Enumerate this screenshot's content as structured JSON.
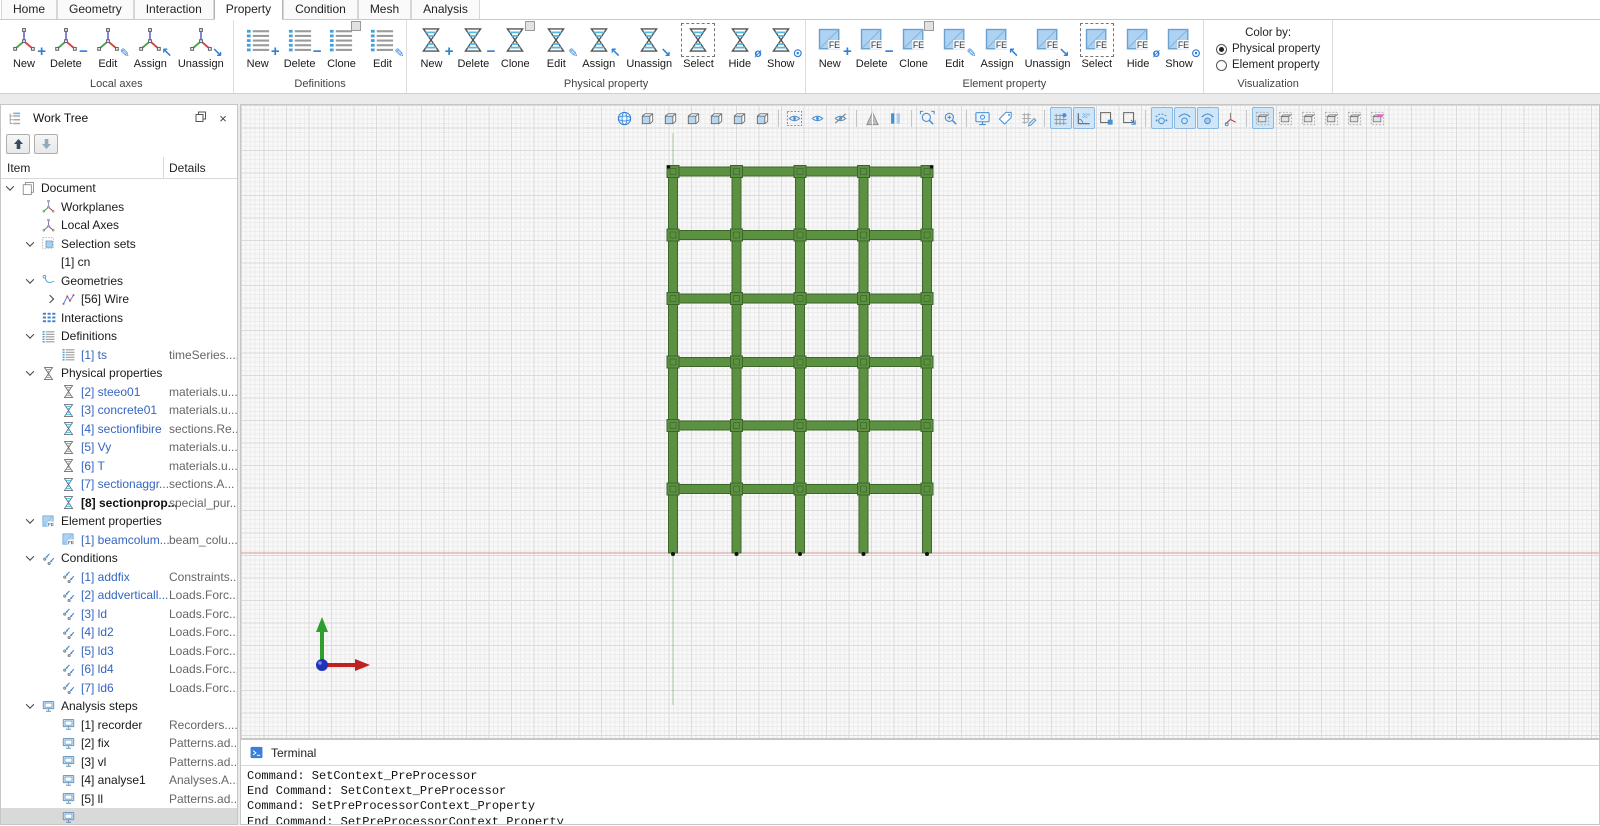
{
  "colors": {
    "accent_blue": "#2f7fd6",
    "toolbar_active_bg": "#cfe6f8",
    "tree_link_blue": "#3565c0",
    "structure_green": "#5b9140",
    "structure_outline": "#3d662b",
    "ground_line_red": "#d77f7f",
    "axis_line_green": "#69a65a",
    "triad_x_red": "#c02020",
    "triad_y_green": "#2e9e2e",
    "triad_origin_blue": "#2233bb"
  },
  "ribbon": {
    "tabs": [
      {
        "label": "Home"
      },
      {
        "label": "Geometry"
      },
      {
        "label": "Interaction"
      },
      {
        "label": "Property"
      },
      {
        "label": "Condition"
      },
      {
        "label": "Mesh"
      },
      {
        "label": "Analysis"
      }
    ],
    "active_tab": "Property",
    "groups": [
      {
        "label": "Local axes",
        "icon": "local-axes",
        "buttons": [
          {
            "label": "New",
            "mod": "plus"
          },
          {
            "label": "Delete",
            "mod": "minus"
          },
          {
            "label": "Edit",
            "mod": "edit"
          },
          {
            "label": "Assign",
            "mod": "assign"
          },
          {
            "label": "Unassign",
            "mod": "unassign"
          }
        ]
      },
      {
        "label": "Definitions",
        "icon": "list",
        "buttons": [
          {
            "label": "New",
            "mod": "plus"
          },
          {
            "label": "Delete",
            "mod": "minus"
          },
          {
            "label": "Clone",
            "mod": "clone"
          },
          {
            "label": "Edit",
            "mod": "edit"
          }
        ]
      },
      {
        "label": "Physical property",
        "icon": "hourglass",
        "buttons": [
          {
            "label": "New",
            "mod": "plus"
          },
          {
            "label": "Delete",
            "mod": "minus"
          },
          {
            "label": "Clone",
            "mod": "clone"
          },
          {
            "label": "Edit",
            "mod": "edit"
          },
          {
            "label": "Assign",
            "mod": "assign"
          },
          {
            "label": "Unassign",
            "mod": "unassign"
          },
          {
            "label": "Select",
            "mod": "select"
          },
          {
            "label": "Hide",
            "mod": "hide"
          },
          {
            "label": "Show",
            "mod": "show"
          }
        ]
      },
      {
        "label": "Element property",
        "icon": "fe-square",
        "buttons": [
          {
            "label": "New",
            "mod": "plus"
          },
          {
            "label": "Delete",
            "mod": "minus"
          },
          {
            "label": "Clone",
            "mod": "clone"
          },
          {
            "label": "Edit",
            "mod": "edit"
          },
          {
            "label": "Assign",
            "mod": "assign"
          },
          {
            "label": "Unassign",
            "mod": "unassign"
          },
          {
            "label": "Select",
            "mod": "select"
          },
          {
            "label": "Hide",
            "mod": "hide"
          },
          {
            "label": "Show",
            "mod": "show"
          }
        ]
      }
    ],
    "visualization": {
      "label": "Visualization",
      "color_by_label": "Color by:",
      "options": [
        {
          "label": "Physical property",
          "selected": true
        },
        {
          "label": "Element property",
          "selected": false
        }
      ]
    }
  },
  "worktree": {
    "title": "Work Tree",
    "columns": [
      "Item",
      "Details"
    ],
    "toolbar": [
      {
        "name": "move-up",
        "enabled": true
      },
      {
        "name": "move-down",
        "enabled": false
      }
    ],
    "rows": [
      {
        "label": "Document",
        "details": "",
        "level": 0,
        "icon": "document",
        "exp": "open",
        "style": "normal"
      },
      {
        "label": "Workplanes",
        "details": "",
        "level": 1,
        "icon": "workplanes",
        "exp": "",
        "style": "normal"
      },
      {
        "label": "Local Axes",
        "details": "",
        "level": 1,
        "icon": "local-axes",
        "exp": "",
        "style": "normal"
      },
      {
        "label": "Selection sets",
        "details": "",
        "level": 1,
        "icon": "selection-sets",
        "exp": "open",
        "style": "normal"
      },
      {
        "label": "[1] cn",
        "details": "",
        "level": 2,
        "icon": "",
        "exp": "",
        "style": "normal"
      },
      {
        "label": "Geometries",
        "details": "",
        "level": 1,
        "icon": "geometries",
        "exp": "open",
        "style": "normal"
      },
      {
        "label": "[56] Wire",
        "details": "",
        "level": 2,
        "icon": "wire",
        "exp": "closed",
        "style": "normal"
      },
      {
        "label": "Interactions",
        "details": "",
        "level": 1,
        "icon": "interactions",
        "exp": "",
        "style": "normal"
      },
      {
        "label": "Definitions",
        "details": "",
        "level": 1,
        "icon": "definitions",
        "exp": "open",
        "style": "normal"
      },
      {
        "label": "[1] ts",
        "details": "timeSeries....",
        "level": 2,
        "icon": "definitions",
        "exp": "",
        "style": "link"
      },
      {
        "label": "Physical properties",
        "details": "",
        "level": 1,
        "icon": "physical",
        "exp": "open",
        "style": "normal"
      },
      {
        "label": "[2] steeo01",
        "details": "materials.u...",
        "level": 2,
        "icon": "physical",
        "exp": "",
        "style": "link"
      },
      {
        "label": "[3] concrete01",
        "details": "materials.u...",
        "level": 2,
        "icon": "physical",
        "exp": "",
        "style": "link"
      },
      {
        "label": "[4] sectionfibire",
        "details": "sections.Re...",
        "level": 2,
        "icon": "physical",
        "exp": "",
        "style": "link"
      },
      {
        "label": "[5] Vy",
        "details": "materials.u...",
        "level": 2,
        "icon": "physical",
        "exp": "",
        "style": "link"
      },
      {
        "label": "[6] T",
        "details": "materials.u...",
        "level": 2,
        "icon": "physical",
        "exp": "",
        "style": "link"
      },
      {
        "label": "[7] sectionaggr...",
        "details": "sections.A...",
        "level": 2,
        "icon": "physical",
        "exp": "",
        "style": "link"
      },
      {
        "label": "[8] sectionprop...",
        "details": "special_pur...",
        "level": 2,
        "icon": "physical",
        "exp": "",
        "style": "bold"
      },
      {
        "label": "Element properties",
        "details": "",
        "level": 1,
        "icon": "element",
        "exp": "open",
        "style": "normal"
      },
      {
        "label": "[1] beamcolum...",
        "details": "beam_colu...",
        "level": 2,
        "icon": "element",
        "exp": "",
        "style": "link"
      },
      {
        "label": "Conditions",
        "details": "",
        "level": 1,
        "icon": "conditions",
        "exp": "open",
        "style": "normal"
      },
      {
        "label": "[1] addfix",
        "details": "Constraints...",
        "level": 2,
        "icon": "conditions",
        "exp": "",
        "style": "link"
      },
      {
        "label": "[2] addverticall...",
        "details": "Loads.Forc...",
        "level": 2,
        "icon": "conditions",
        "exp": "",
        "style": "link"
      },
      {
        "label": "[3] ld",
        "details": "Loads.Forc...",
        "level": 2,
        "icon": "conditions",
        "exp": "",
        "style": "link"
      },
      {
        "label": "[4] ld2",
        "details": "Loads.Forc...",
        "level": 2,
        "icon": "conditions",
        "exp": "",
        "style": "link"
      },
      {
        "label": "[5] ld3",
        "details": "Loads.Forc...",
        "level": 2,
        "icon": "conditions",
        "exp": "",
        "style": "link"
      },
      {
        "label": "[6] ld4",
        "details": "Loads.Forc...",
        "level": 2,
        "icon": "conditions",
        "exp": "",
        "style": "link"
      },
      {
        "label": "[7] ld6",
        "details": "Loads.Forc...",
        "level": 2,
        "icon": "conditions",
        "exp": "",
        "style": "link"
      },
      {
        "label": "Analysis steps",
        "details": "",
        "level": 1,
        "icon": "analysis",
        "exp": "open",
        "style": "normal"
      },
      {
        "label": "[1] recorder",
        "details": "Recorders....",
        "level": 2,
        "icon": "analysis",
        "exp": "",
        "style": "normal"
      },
      {
        "label": "[2] fix",
        "details": "Patterns.ad...",
        "level": 2,
        "icon": "analysis",
        "exp": "",
        "style": "normal"
      },
      {
        "label": "[3] vl",
        "details": "Patterns.ad...",
        "level": 2,
        "icon": "analysis",
        "exp": "",
        "style": "normal"
      },
      {
        "label": "[4] analyse1",
        "details": "Analyses.A...",
        "level": 2,
        "icon": "analysis",
        "exp": "",
        "style": "normal"
      },
      {
        "label": "[5] ll",
        "details": "Patterns.ad...",
        "level": 2,
        "icon": "analysis",
        "exp": "",
        "style": "normal"
      },
      {
        "label": "",
        "details": "",
        "level": 2,
        "icon": "analysis",
        "exp": "",
        "style": "normal",
        "selected": true
      }
    ]
  },
  "viewport": {
    "toolbar": [
      {
        "name": "isometric-view"
      },
      {
        "name": "front-view"
      },
      {
        "name": "back-view"
      },
      {
        "name": "left-view"
      },
      {
        "name": "right-view"
      },
      {
        "name": "top-view"
      },
      {
        "name": "bottom-view"
      },
      {
        "sep": true
      },
      {
        "name": "select-visibility"
      },
      {
        "name": "show-selected"
      },
      {
        "name": "hide-selected"
      },
      {
        "sep": true
      },
      {
        "name": "perspective-view"
      },
      {
        "name": "parallel-view"
      },
      {
        "sep": true
      },
      {
        "name": "zoom-fit"
      },
      {
        "name": "zoom-in"
      },
      {
        "sep": true
      },
      {
        "name": "display-options"
      },
      {
        "name": "annotations"
      },
      {
        "name": "edit-grid"
      },
      {
        "sep": true
      },
      {
        "name": "grid-toggle",
        "active": true
      },
      {
        "name": "angle-snap",
        "active": true
      },
      {
        "name": "clip-box"
      },
      {
        "name": "clip-box-edit"
      },
      {
        "sep": true
      },
      {
        "name": "show-vertices",
        "active": true
      },
      {
        "name": "show-edges",
        "active": true
      },
      {
        "name": "show-faces",
        "active": true
      },
      {
        "name": "show-local-axes"
      },
      {
        "sep": true
      },
      {
        "name": "slice-select",
        "active": true
      },
      {
        "name": "slice-box-1"
      },
      {
        "name": "slice-box-2"
      },
      {
        "name": "slice-box-3"
      },
      {
        "name": "slice-box-4"
      },
      {
        "name": "slice-colors"
      }
    ],
    "structure": {
      "columns_x": [
        432,
        495.5,
        559,
        622.5,
        686
      ],
      "beams_y": [
        66.5,
        130,
        193.5,
        257,
        320.5,
        384
      ],
      "top_y": 62,
      "base_y": 448,
      "member_thickness": 9,
      "beam_left": 427.5,
      "beam_right": 690.5
    },
    "axis_line": {
      "x": 432,
      "y1": 28,
      "y2": 600
    },
    "ground_line": {
      "y": 448
    },
    "triad": {
      "origin_x": 81,
      "origin_y": 560,
      "arrow_len": 44
    }
  },
  "terminal": {
    "title": "Terminal",
    "lines": [
      "Command: SetContext_PreProcessor",
      "End Command: SetContext_PreProcessor",
      "Command: SetPreProcessorContext_Property",
      "End Command: SetPreProcessorContext_Property"
    ]
  }
}
